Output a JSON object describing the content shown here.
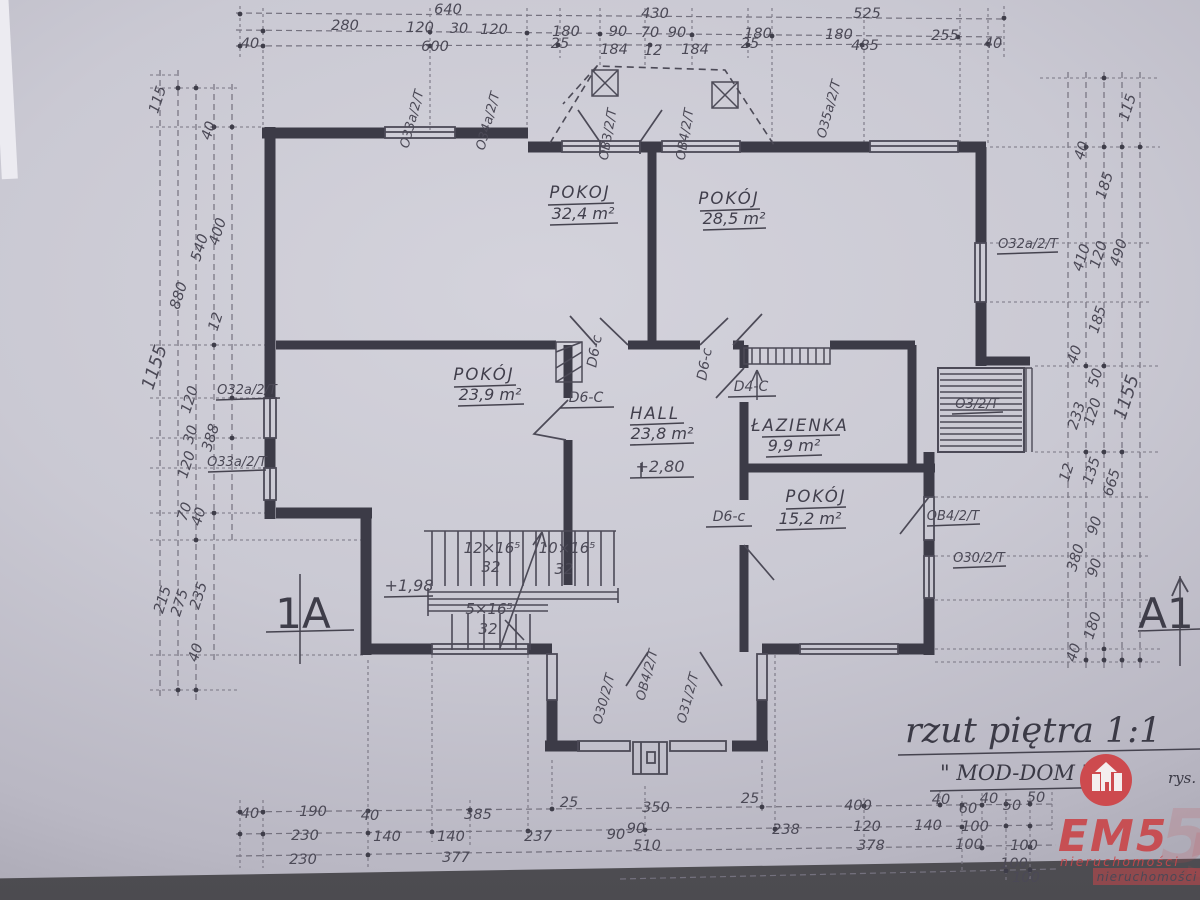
{
  "title_block": {
    "title": "rzut piętra 1:1",
    "studio": "\" MOD-DOM \"",
    "rys": "rys."
  },
  "section_markers": {
    "left": "1A",
    "right": "A1"
  },
  "rooms": [
    {
      "name": "POKOJ",
      "area": "32,4 m²"
    },
    {
      "name": "POKÓJ",
      "area": "28,5 m²"
    },
    {
      "name": "POKÓJ",
      "area": "23,9 m²"
    },
    {
      "name": "HALL",
      "area": "23,8 m²"
    },
    {
      "name": "ŁAZIENKA",
      "area": "9,9 m²"
    },
    {
      "name": "POKÓJ",
      "area": "15,2 m²"
    }
  ],
  "levels": {
    "floor": "+2,80",
    "landing": "+1,98"
  },
  "stairs": {
    "f1": "12×16⁵",
    "f1t": "32",
    "f2": "10×16⁵",
    "f2t": "32",
    "f3": "5×16⁵",
    "f3t": "32"
  },
  "doors": {
    "d1": "D6-c",
    "d2": "D6-c",
    "d3": "D6-C",
    "d4": "D4-C",
    "d5": "D6-c"
  },
  "windows": {
    "t1": "O33a/2/T",
    "t2": "O34a/2/T",
    "t3": "OB3/2/T",
    "t4": "OB4/2/T",
    "t5": "O35a/2/T",
    "l1": "O32a/2/T",
    "l2": "O33a/2/T",
    "r1": "O32a/2/T",
    "r2": "O3/2/T",
    "r3": "OB4/2/T",
    "r4": "O30/2/T",
    "b1": "O30/2/T",
    "b2": "OB4/2/T",
    "b3": "O31/2/T"
  },
  "dims": {
    "top": {
      "r1": [
        "640",
        "430",
        "525"
      ],
      "r2": [
        "280",
        "120",
        "30",
        "120",
        "180",
        "90",
        "70",
        "90",
        "180",
        "180",
        "255"
      ],
      "r3": [
        "40",
        "600",
        "25",
        "184",
        "12",
        "184",
        "25",
        "485",
        "40"
      ]
    },
    "left": [
      "115",
      "40",
      "400",
      "540",
      "880",
      "12",
      "1155",
      "120",
      "30",
      "388",
      "120",
      "70",
      "40",
      "215",
      "275",
      "235",
      "40"
    ],
    "right": [
      "115",
      "40",
      "185",
      "410",
      "120",
      "490",
      "185",
      "40",
      "50",
      "120",
      "233",
      "1155",
      "12",
      "135",
      "665",
      "90",
      "90",
      "380",
      "180",
      "40"
    ],
    "bottom": {
      "r1": [
        "40",
        "190",
        "40",
        "385",
        "25",
        "350",
        "25",
        "400",
        "40",
        "60",
        "40",
        "50",
        "50"
      ],
      "r2": [
        "230",
        "140",
        "140",
        "237",
        "90",
        "90",
        "238",
        "120",
        "140",
        "100"
      ],
      "r3": [
        "230",
        "377",
        "510",
        "378",
        "100",
        "100"
      ],
      "r4": [
        "100",
        "100"
      ]
    }
  },
  "watermark": {
    "brand": "EM5",
    "subtitle": "nieruchomości",
    "band": "nieruchomości",
    "ghost": "5",
    "accent": "#c9474b"
  }
}
